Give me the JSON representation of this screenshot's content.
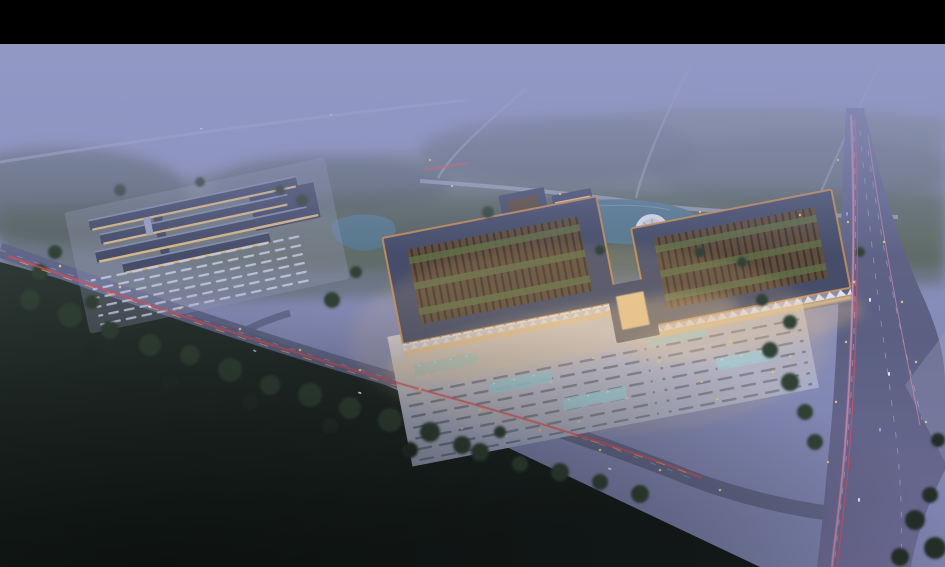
{
  "colors": {
    "letterbox": "#000000",
    "skyTop": "#9196c3",
    "skyMid": "#868bb7",
    "skyLow": "#7a7fab",
    "fog": "#9398c4",
    "forestHaze": "#5c6b51",
    "forestDark": "#3b4836",
    "tree": "#2c3a2a",
    "treeDeep": "#1d281c",
    "grassMid": "#46543e",
    "fieldTop": "#26322a",
    "fieldBottom": "#0b100d",
    "roadFog": "#a9adcc",
    "roadTop": "#61658a",
    "roadMid": "#585c7e",
    "roadBottom": "#6b6790",
    "roadSide": "#5d6183",
    "roadVerge": "#9ba0bf",
    "laneMark": "#c6cade",
    "trailRed": "#e8474e",
    "trailOrange": "#f0a062",
    "trailPink": "#ee8fae",
    "trailCrimson": "#d84a62",
    "carWhite": "#e9edff",
    "carBlue": "#7fa8e8",
    "lamp": "#f6c87e",
    "plazaTop": "#d9d5da",
    "plazaBottom": "#a9afcb",
    "plazaRow": "#60657f",
    "stallMark": "#c9cee6",
    "poolCyan": "#9ccfe0",
    "poolDot": "#bdeef8",
    "roofDark": "#414863",
    "roofEdgeLight": "#9aa0bf",
    "latticeBrown": "#5e4731",
    "latticeStripe": "#2c2a26",
    "greenStrip": "#5d6b3e",
    "trimOrange": "#cc8d4e",
    "eaveWhite": "#e9ebf4",
    "glowWarm": "#eec487",
    "windowWarm": "#f0c98c",
    "pond": "#53788e",
    "pondEdge": "#86a9ba",
    "discFill": "#dde0ea",
    "discInner": "#c9cdd9",
    "discLine": "#9ba0b4",
    "rowRoof": "#5a6182",
    "rowEdge": "#9aa0c0",
    "vignette": "#0a0f0c"
  }
}
